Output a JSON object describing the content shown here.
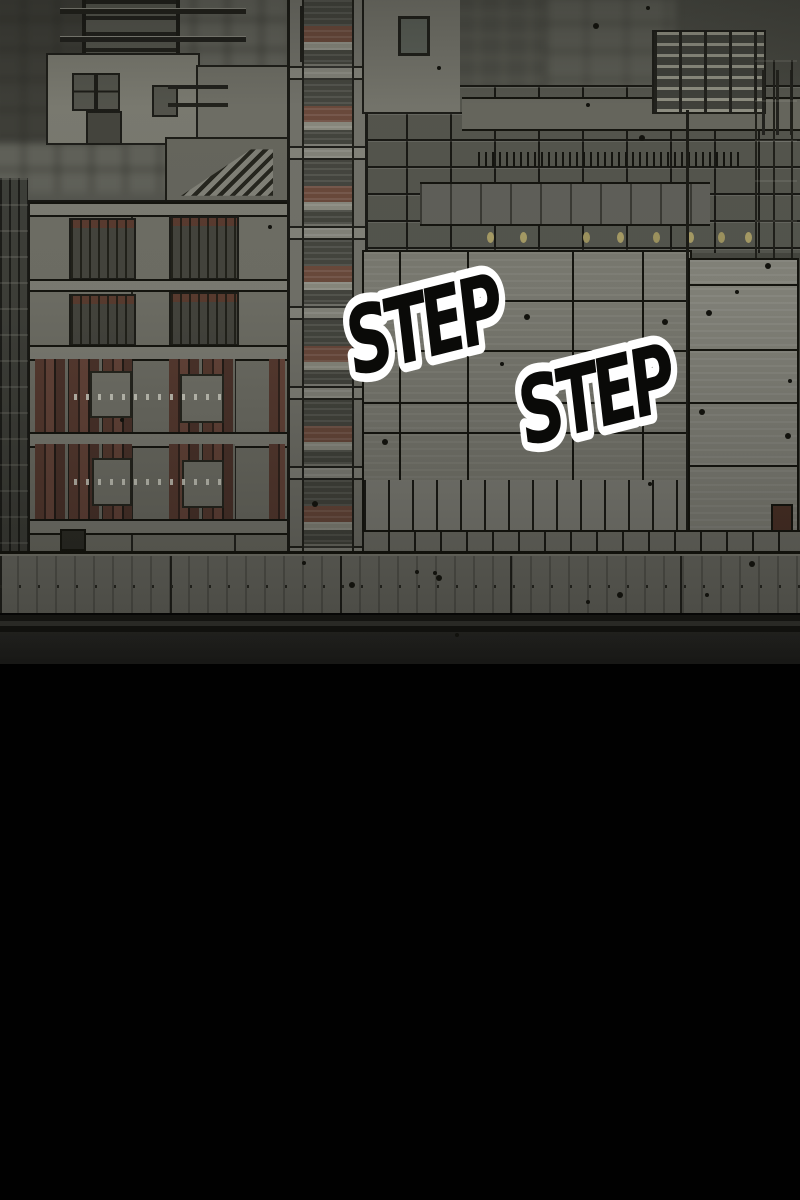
{
  "panel": {
    "type": "webtoon-comic-panel",
    "scene": "construction-site-cityscape",
    "sfx": [
      {
        "text": "STEP"
      },
      {
        "text": "STEP"
      }
    ],
    "palette": {
      "sky": "#54554e",
      "concrete_light": "#7d7d74",
      "concrete_mid": "#6f6f66",
      "concrete_dark": "#45463f",
      "formwork_brown": "#5a3c32",
      "outline_ink": "#15150f",
      "fence": "#6c6c64",
      "road": "#2d2d2a",
      "lamp_yellow": "#a89d66",
      "sfx_fill": "#0a0a08",
      "sfx_outline": "#ffffff",
      "bottom": "#010101"
    }
  }
}
